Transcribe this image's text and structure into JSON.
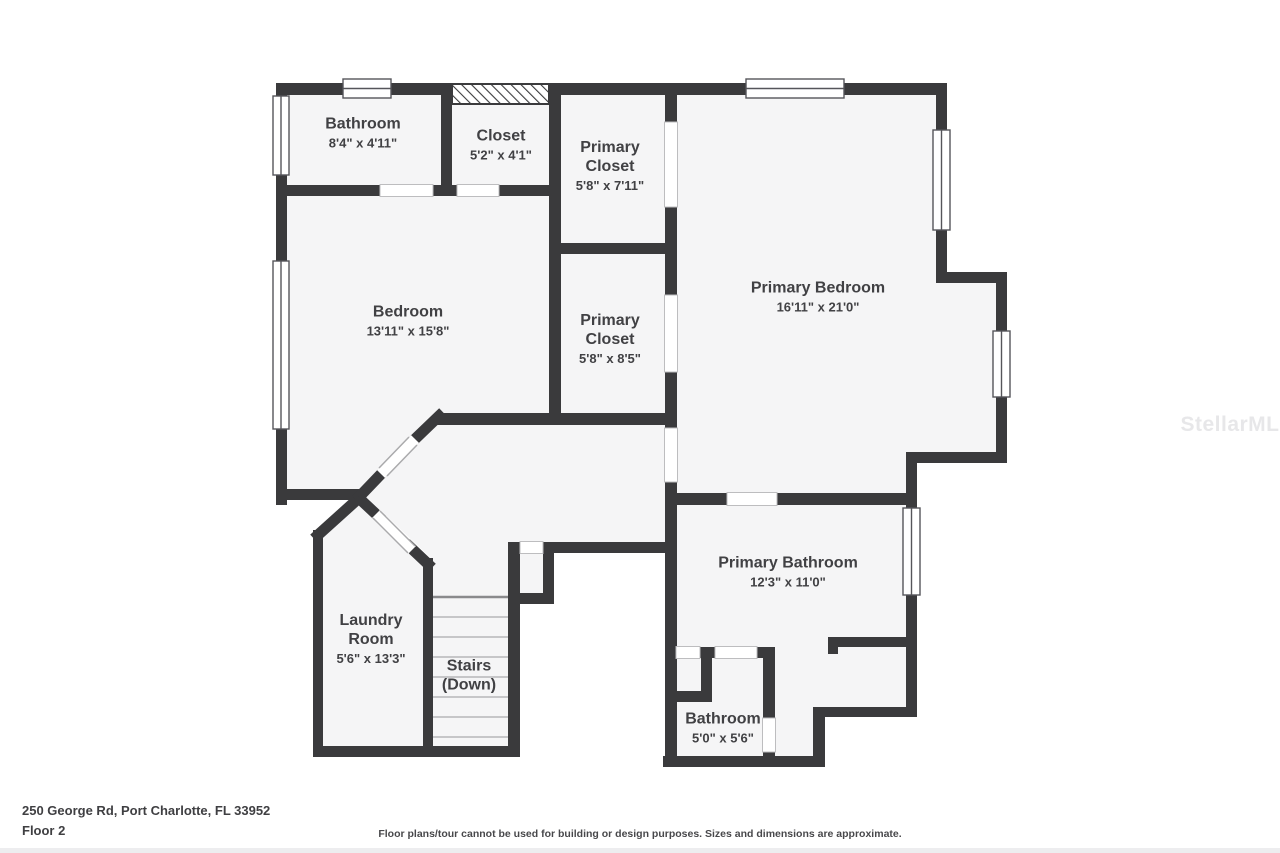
{
  "colors": {
    "wall": "#3a3a3c",
    "room_fill": "#f5f5f6",
    "background": "#ffffff",
    "label_text": "#414144",
    "stair_line": "#c6c6c8",
    "watermark": "#e7e7e9"
  },
  "rooms": [
    {
      "id": "bathroom-upper",
      "name": "Bathroom",
      "dims": "8'4\" x 4'11\""
    },
    {
      "id": "closet",
      "name": "Closet",
      "dims": "5'2\" x 4'1\""
    },
    {
      "id": "primary-closet-1",
      "name": "Primary\nCloset",
      "dims": "5'8\" x 7'11\""
    },
    {
      "id": "bedroom",
      "name": "Bedroom",
      "dims": "13'11\" x 15'8\""
    },
    {
      "id": "primary-closet-2",
      "name": "Primary\nCloset",
      "dims": "5'8\" x 8'5\""
    },
    {
      "id": "primary-bedroom",
      "name": "Primary Bedroom",
      "dims": "16'11\" x 21'0\""
    },
    {
      "id": "primary-bathroom",
      "name": "Primary Bathroom",
      "dims": "12'3\" x 11'0\""
    },
    {
      "id": "laundry",
      "name": "Laundry\nRoom",
      "dims": "5'6\" x 13'3\""
    },
    {
      "id": "stairs",
      "name": "Stairs\n(Down)",
      "dims": ""
    },
    {
      "id": "bathroom-lower",
      "name": "Bathroom",
      "dims": "5'0\" x 5'6\""
    }
  ],
  "footer": {
    "address": "250 George Rd, Port Charlotte, FL 33952",
    "floor": "Floor 2",
    "disclaimer": "Floor plans/tour cannot be used for building or design purposes. Sizes and dimensions are approximate."
  },
  "watermark": "StellarMLS"
}
